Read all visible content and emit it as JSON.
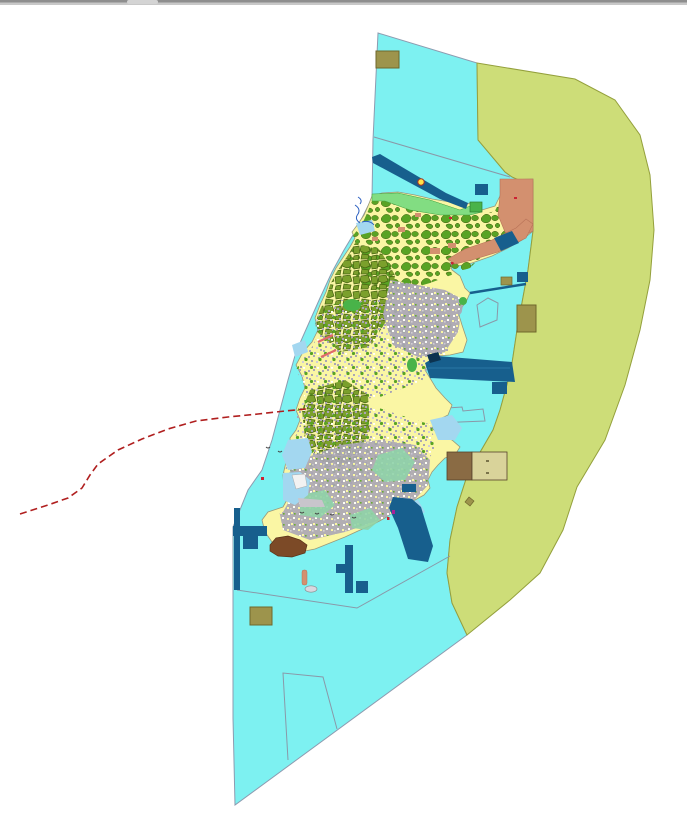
{
  "window": {
    "top_bar": {
      "kind": "splitter-bar",
      "has_drag_handle": true
    }
  },
  "map": {
    "type": "land-use-zoning-map",
    "description": "Island land-use mosaic with marine zone, coastal buffer zone, harbor structures and boundary line",
    "layers": [
      {
        "name": "marine-zone",
        "color_key": "sea"
      },
      {
        "name": "coastal-buffer-zone",
        "color_key": "coastal_zone"
      },
      {
        "name": "island-landuse",
        "color_key": "island_base"
      },
      {
        "name": "forest-patches",
        "color_key": "forest_green"
      },
      {
        "name": "orchard-cluster",
        "color_key": "olive_cluster"
      },
      {
        "name": "urban-area",
        "color_key": "urban_gray"
      },
      {
        "name": "wetland",
        "color_key": "light_blue"
      },
      {
        "name": "coastal-greenbelt",
        "color_key": "coast_green"
      },
      {
        "name": "development-zone",
        "color_key": "salmon"
      },
      {
        "name": "harbor-structures",
        "color_key": "navy"
      },
      {
        "name": "reclamation-blocks",
        "color_key": "khaki"
      },
      {
        "name": "mudflat",
        "color_key": "brown"
      },
      {
        "name": "administrative-boundary",
        "color_key": "red_boundary"
      },
      {
        "name": "parcel-outlines",
        "color_key": "parcel_outline"
      }
    ],
    "colors": {
      "background": "#ffffff",
      "sea": "#7df1f1",
      "sea_border": "#8d9bb0",
      "coastal_zone": "#cddd78",
      "coastal_zone_border": "#94a03c",
      "island_base": "#faf6a4",
      "island_border": "#99987a",
      "forest_green": "#58a324",
      "olive_cluster": "#7ba02c",
      "olive_outline": "#44610f",
      "urban_gray": "#aaa6b5",
      "urban_light": "#cfcbd8",
      "teal_green": "#8fd3a8",
      "light_blue": "#a3d7f0",
      "coast_green": "#82dd82",
      "coast_green_border": "#3f9f3f",
      "salmon": "#d3906f",
      "salmon_border": "#b87258",
      "brown": "#7c4a27",
      "brown_border": "#5a3318",
      "khaki": "#9d944c",
      "khaki_border": "#6f672c",
      "tan_block": "#d9d39a",
      "mud_brown": "#8a6b44",
      "navy": "#175f8d",
      "navy_dark": "#0c3350",
      "navy_light": "#2f7fae",
      "bright_green": "#49b349",
      "bright_green_border": "#2e7d2e",
      "red_boundary": "#b01f1f",
      "red_dot": "#cc2233",
      "magenta_dot": "#aa2299",
      "pink": "#e06a6a",
      "stream_blue": "#2b5fc0",
      "parcel_outline": "#8a98a8",
      "buoy_yellow": "#ffe24a",
      "islet_gray": "#d8d8e0",
      "bar_gray": "#8e8e8e",
      "bar_light": "#c8c8c8",
      "bar_handle": "#d4d4d4"
    }
  }
}
